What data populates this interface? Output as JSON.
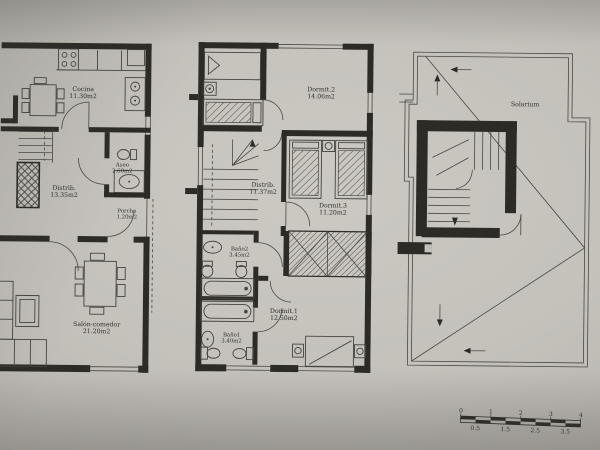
{
  "photo": {
    "paper_color": "#c6c4bd",
    "ink_color": "#2c2b26"
  },
  "plans": [
    {
      "rooms": [
        {
          "label": "Cocina",
          "area": "11.30m2"
        },
        {
          "label": "Distrib.",
          "area": "13.35m2"
        },
        {
          "label": "Aseo",
          "area": "2.60m2"
        },
        {
          "label": "Porche",
          "area": "1.20m2"
        },
        {
          "label": "Salón-comedor",
          "area": "21.20m2"
        }
      ]
    },
    {
      "rooms": [
        {
          "label": "Dormit.2",
          "area": "14.06m2"
        },
        {
          "label": "Distrib.",
          "area": "11.37m2"
        },
        {
          "label": "Dormit.3",
          "area": "11.20m2"
        },
        {
          "label": "Baño2",
          "area": "3.45m2"
        },
        {
          "label": "Dormit.1",
          "area": "12.50m2"
        },
        {
          "label": "Baño1",
          "area": "3.40m2"
        }
      ]
    },
    {
      "rooms": [
        {
          "label": "Solarium",
          "area": ""
        }
      ]
    }
  ],
  "scale_bar": {
    "top_labels": [
      "0",
      "1",
      "2",
      "3",
      "4"
    ],
    "bottom_labels": [
      "0.5",
      "1.5",
      "2.5",
      "3.5"
    ]
  }
}
